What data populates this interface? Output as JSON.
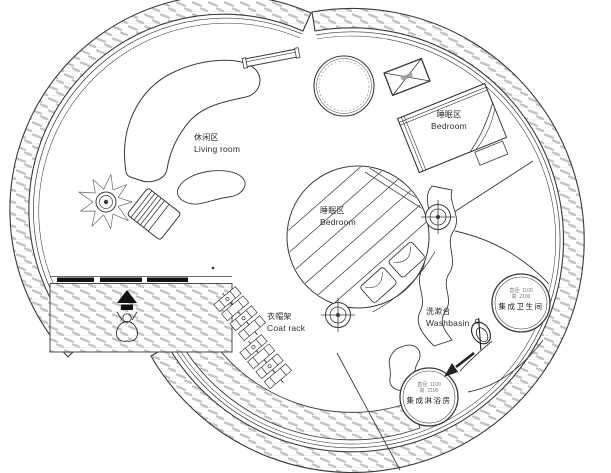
{
  "drawing_title": "圆形住宅平面图 (circular house floor plan)",
  "colors": {
    "line": "#3a3a3a",
    "hatch": "#c3c3c3",
    "fill_black": "#111111",
    "background": "#ffffff"
  },
  "labels": {
    "living": {
      "zh": "休闲区",
      "en": "Living room"
    },
    "bedroom_loft": {
      "zh": "睡眠区",
      "en": "Bedroom"
    },
    "bedroom_center": {
      "zh": "睡眠区",
      "en": "Bedroom"
    },
    "coat_rack": {
      "zh": "衣帽架",
      "en": "Coat rack"
    },
    "washbasin": {
      "zh": "洗漱台",
      "en": "Washbasin"
    },
    "bathroom_pod": {
      "name": "集成卫生间",
      "dim1": "直径: 1100",
      "dim2": "高: 2100"
    },
    "shower_pod": {
      "name": "集成淋浴房",
      "dim1": "直径: 1100",
      "dim2": "高: 2100"
    }
  }
}
